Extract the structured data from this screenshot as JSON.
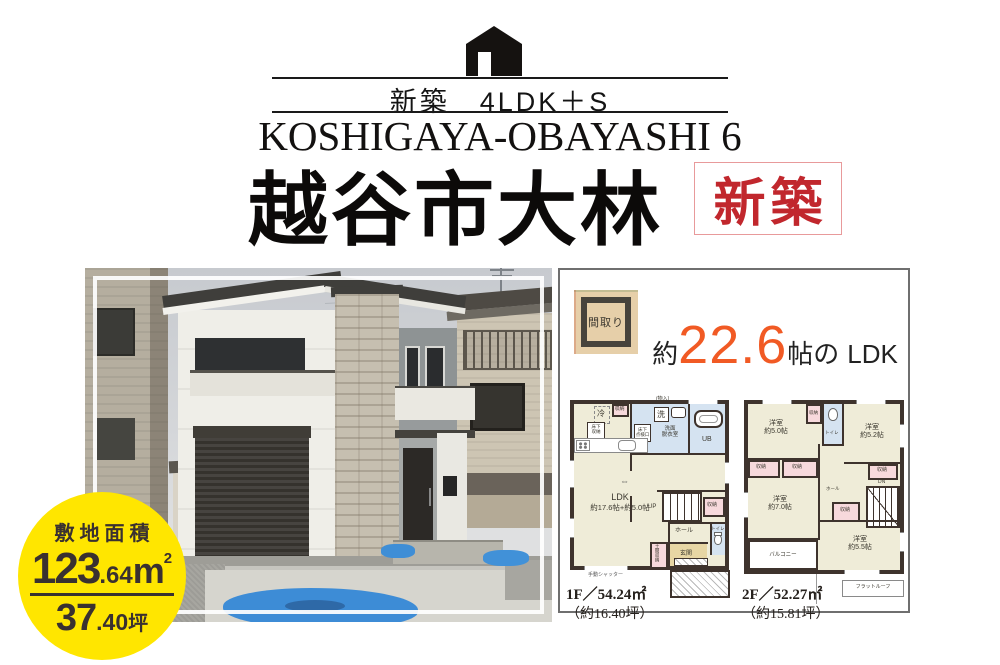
{
  "header": {
    "tagline": "新築　4LDK＋S",
    "romaji": "KOSHIGAYA-OBAYASHI 6",
    "title": "越谷市大林",
    "badge_label": "新築",
    "badge_color": "#c1272d"
  },
  "site_badge": {
    "label": "敷地面積",
    "area_int": "123",
    "area_frac": ".64",
    "area_unit": "m",
    "area_exp": "2",
    "tsubo_int": "37",
    "tsubo_frac": ".40",
    "tsubo_unit": "坪",
    "bg_color": "#ffe600",
    "text_color": "#3a3130"
  },
  "floorplan_panel": {
    "stamp_label": "間取り",
    "ldk": {
      "prefix": "約",
      "value": "22.6",
      "suffix_jo": "帖の",
      "suffix_ldk": "LDK"
    },
    "accent_color": "#f15a24",
    "labels": {
      "closet": "収納",
      "fridge": "冷",
      "washer": "洗",
      "mono": "(物入)",
      "senmen1": "洗面",
      "senmen2": "脱衣室",
      "inspection1": "床下",
      "inspection2": "点検口",
      "ub": "UB",
      "underfloor1": "床下",
      "underfloor2": "収納",
      "ldk": "LDK",
      "ldk_size": "約17.6帖+約5.0帖",
      "slide": "⇔",
      "up": "UP",
      "dn": "DN",
      "hall": "ホール",
      "toilet": "トイレ",
      "genkan": "玄関",
      "doma": "土間収納",
      "shutter": "手動シャッター",
      "balcony": "バルコニー",
      "flatroof": "フラットルーフ"
    },
    "f1": {
      "floor_label": "1F／54.24㎡",
      "floor_sub": "（約16.40坪）"
    },
    "f2": {
      "floor_label": "2F／52.27㎡",
      "floor_sub": "（約15.81坪）",
      "rooms": [
        {
          "name": "洋室",
          "size": "約5.0帖"
        },
        {
          "name": "洋室",
          "size": "約5.2帖"
        },
        {
          "name": "洋室",
          "size": "約7.0帖"
        },
        {
          "name": "洋室",
          "size": "約5.5帖"
        }
      ]
    }
  }
}
